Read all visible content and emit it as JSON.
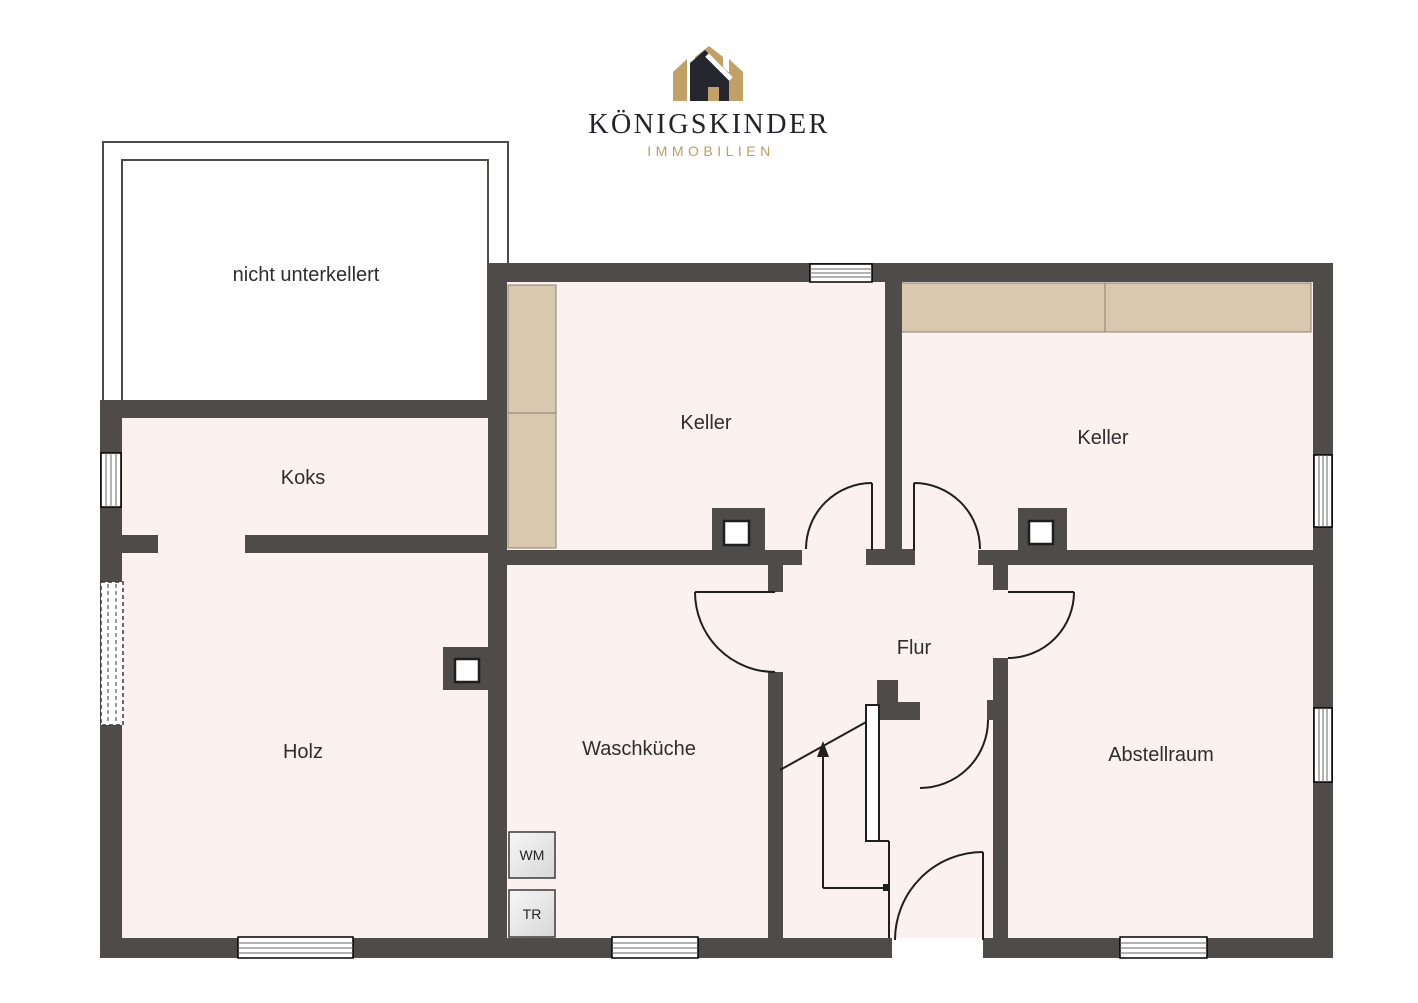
{
  "brand": {
    "name": "KÖNIGSKINDER",
    "tagline": "IMMOBILIEN"
  },
  "plan": {
    "rooms": {
      "nicht_unterkellert": "nicht unterkellert",
      "koks": "Koks",
      "keller_left": "Keller",
      "keller_right": "Keller",
      "holz": "Holz",
      "waschkueche": "Waschküche",
      "flur": "Flur",
      "abstellraum": "Abstellraum"
    },
    "appliances": {
      "wm": "WM",
      "tr": "TR"
    },
    "colors": {
      "wall": "#4f4b48",
      "room_fill": "#fbf1ef",
      "furniture_fill": "#d9c8b0",
      "logo_gold": "#c2a167",
      "logo_dark": "#26262e",
      "tagline_gold": "#c09c5f"
    }
  }
}
